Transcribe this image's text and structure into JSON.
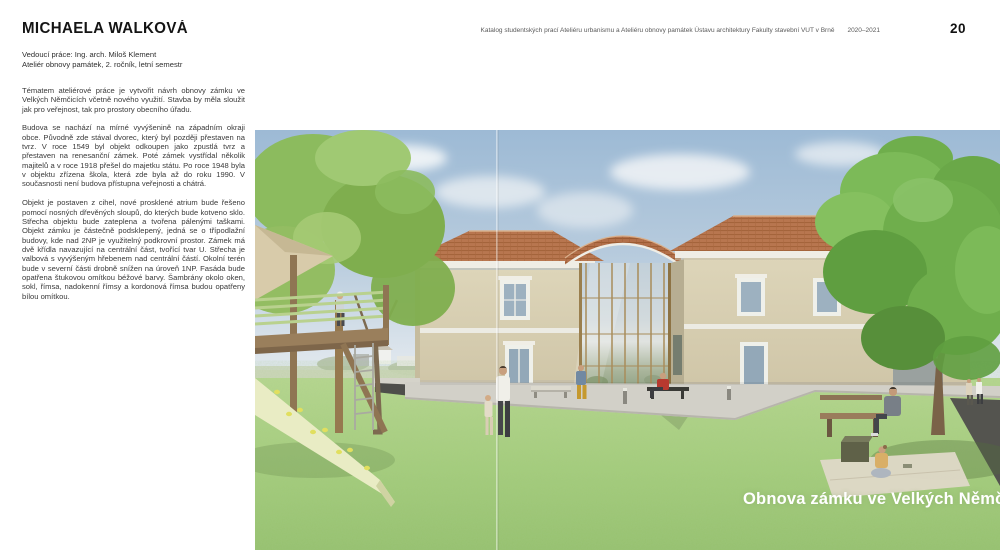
{
  "page": {
    "number": "20",
    "header": "Katalog studentských prací Ateliéru urbanismu a Ateliéru obnovy památek Ústavu architektury Fakulty stavební VUT v Brně",
    "year_range": "2020–2021"
  },
  "student": {
    "name": "MICHAELA WALKOVÁ",
    "supervisor": "Vedoucí práce: Ing. arch. Miloš Klement",
    "studio": "Ateliér obnovy památek, 2. ročník, letní semestr"
  },
  "body": {
    "paragraph1": "Tématem ateliérové práce je vytvořit návrh obnovy zámku ve Velkých Němčicích včetně nového využití. Stavba by měla sloužit jak pro veřejnost, tak pro prostory obecního úřadu.",
    "paragraph2": "Budova se nachází na mírné vyvýšenině na západním okraji obce. Původně zde stával dvorec, který byl později přestaven na tvrz. V roce 1549 byl objekt odkoupen jako zpustlá tvrz a přestaven na renesanční zámek. Poté zámek vystřídal několik majitelů a v roce 1918 přešel do majetku státu. Po roce 1948 byla v objektu zřízena škola, která zde byla až do roku 1990. V současnosti není budova přístupna veřejnosti a chátrá.",
    "paragraph3": "Objekt je postaven z cihel, nové prosklené atrium bude řešeno pomocí nosných dřevěných sloupů, do kterých bude kotveno sklo. Střecha objektu bude zateplena a tvořena pálenými taškami. Objekt zámku je částečně podsklepený, jedná se o třípodlažní budovy, kde nad 2NP je využitelný podkrovní prostor. Zámek má dvě křídla navazující na centrální část, tvořící tvar U. Střecha je valbová s vyvýšeným hřebenem nad centrální částí. Okolní terén bude v severní části drobně snížen na úroveň 1NP. Fasáda bude opatřena štukovou omítkou béžové barvy. Šambrány okolo oken, sokl, římsa, nadokenní římsy a kordonová římsa budou opatřeny bílou omítkou.",
    "paragraph_gap_note": ""
  },
  "image": {
    "caption": "Obnova zámku ve Velkých Němčicích"
  },
  "colors": {
    "sky": "#a9c3d9",
    "grass": "#a3cb79",
    "roof_terracotta": "#b3704a",
    "facade_beige": "#d8cfb2",
    "caption_text": "#ffffff"
  }
}
